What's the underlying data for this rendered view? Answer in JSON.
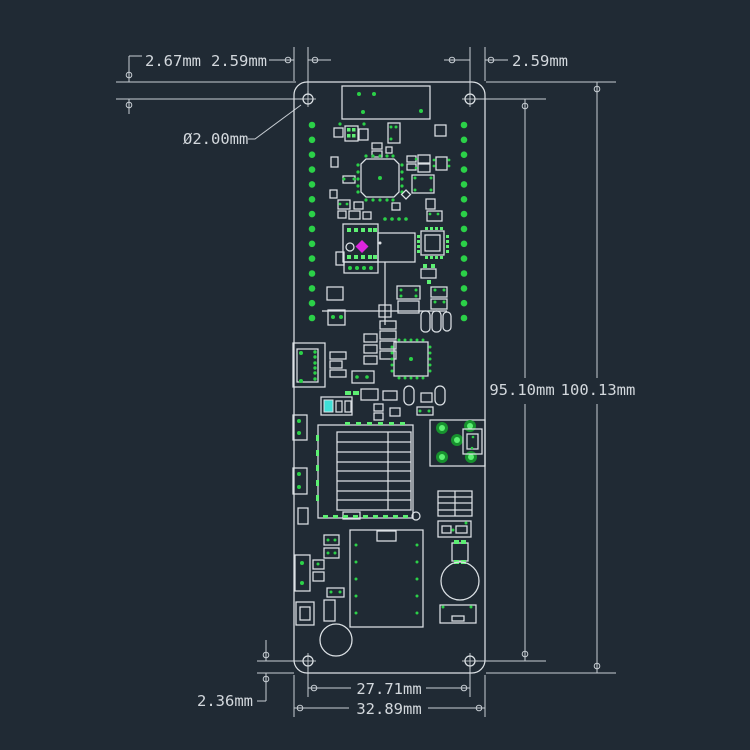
{
  "drawing": {
    "type": "pcb-mechanical-dimension-drawing",
    "board": {
      "pins_per_side": 14
    }
  },
  "colors": {
    "background": "#202a34",
    "line": "#dce1e5",
    "dimension_line": "#c7cdd3",
    "text": "#d3d8dd",
    "pad_green": "#2bd148",
    "marker_magenta": "#de25de",
    "led_cyan": "#3fe0d7"
  },
  "dimensions": {
    "top_edge_to_hole": "2.67mm",
    "left_edge_to_hole": "2.59mm",
    "right_edge_to_hole": "2.59mm",
    "hole_diameter": "Ø2.00mm",
    "hole_to_hole_height": "95.10mm",
    "overall_height": "100.13mm",
    "bottom_edge_to_hole": "2.36mm",
    "hole_to_hole_width": "27.71mm",
    "overall_width": "32.89mm"
  }
}
